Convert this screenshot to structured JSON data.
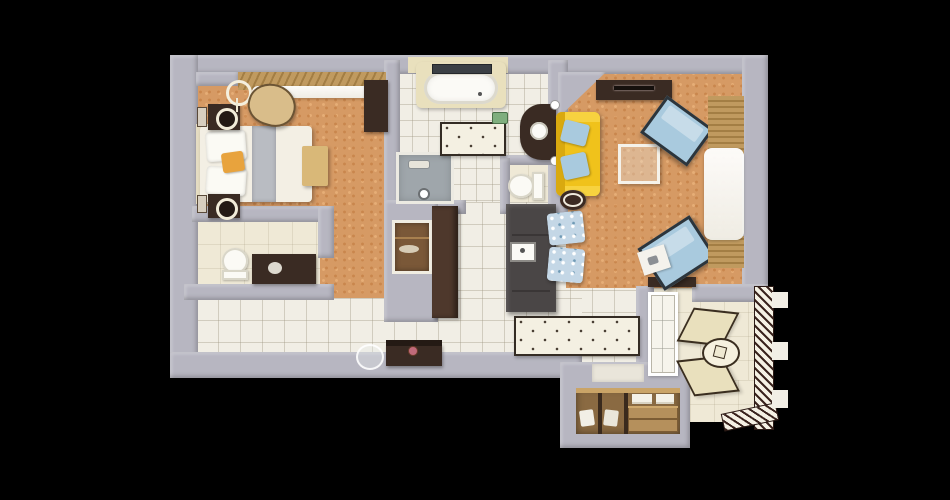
{
  "scene": {
    "type": "apartment-floor-plan-3d-top-view",
    "rooms": [
      {
        "id": "bedroom",
        "floor": "orange-carpet",
        "furniture": [
          "double-bed",
          "headboard",
          "bed-runner",
          "orange-pillow",
          "bench",
          "nightstand",
          "table-lamp",
          "wall-sconce",
          "floor-lamp",
          "armchair",
          "wardrobe",
          "window-blinds",
          "sheer-curtain"
        ]
      },
      {
        "id": "main-bathroom",
        "floor": "white-tile",
        "furniture": [
          "bathtub",
          "tub-window",
          "shower-stall",
          "vanity-counter",
          "sink",
          "toilet",
          "bath-mat",
          "soap-dish"
        ]
      },
      {
        "id": "guest-bathroom",
        "floor": "cream-tile",
        "furniture": [
          "toilet",
          "dark-counter"
        ]
      },
      {
        "id": "kitchen",
        "floor": "white-tile",
        "furniture": [
          "tall-cabinet",
          "island-counter",
          "kitchen-sink",
          "dining-chair",
          "dining-chair",
          "runner-rug",
          "wall-niche"
        ]
      },
      {
        "id": "living-room",
        "floor": "orange-carpet",
        "furniture": [
          "tv-console",
          "yellow-sofa",
          "blue-pillow",
          "blue-pillow",
          "side-table",
          "coffee-table",
          "lounge-chair",
          "lounge-chair",
          "small-desk",
          "window-blinds",
          "sheer-curtain"
        ]
      },
      {
        "id": "entry-hall",
        "floor": "white-tile",
        "furniture": [
          "console-table",
          "flower-vase",
          "round-mirror"
        ]
      },
      {
        "id": "closet",
        "floor": "wood",
        "furniture": [
          "shelving",
          "folded-linens",
          "drawer-box",
          "hanging-clothes"
        ]
      },
      {
        "id": "balcony",
        "floor": "cream-tile",
        "furniture": [
          "sun-lounger",
          "sun-lounger",
          "round-table",
          "hatched-railing",
          "railing-posts",
          "balcony-door"
        ]
      }
    ]
  },
  "palette": {
    "black": "#000000",
    "wall": "#b7b6c1",
    "wallShade": "#9d9ca9",
    "wallLight": "#cecdd7",
    "carpet": "#d69a64",
    "carpetSpot": "#c07c45",
    "tile": "#f1eee5",
    "tileLine": "#c9c4b4",
    "cream": "#efe9d6",
    "creamDeep": "#e9e0bd",
    "wood": "#c09a5f",
    "woodDark": "#8a6a42",
    "darkBrown": "#3a2b23",
    "charcoal": "#4a4646",
    "cabinetBrown": "#4e382c",
    "yellow": "#f0c21b",
    "yellowDark": "#d9a90f",
    "blue": "#a9cade",
    "blueFrame": "#2c353c",
    "white": "#f7f5ee",
    "showerGray": "#9fa6ab",
    "railHatch": "#3a241e",
    "green": "#7fae7e",
    "rug": "#f4f0e2",
    "rugBorder": "#342c24",
    "glass": "#e4ebe9"
  }
}
